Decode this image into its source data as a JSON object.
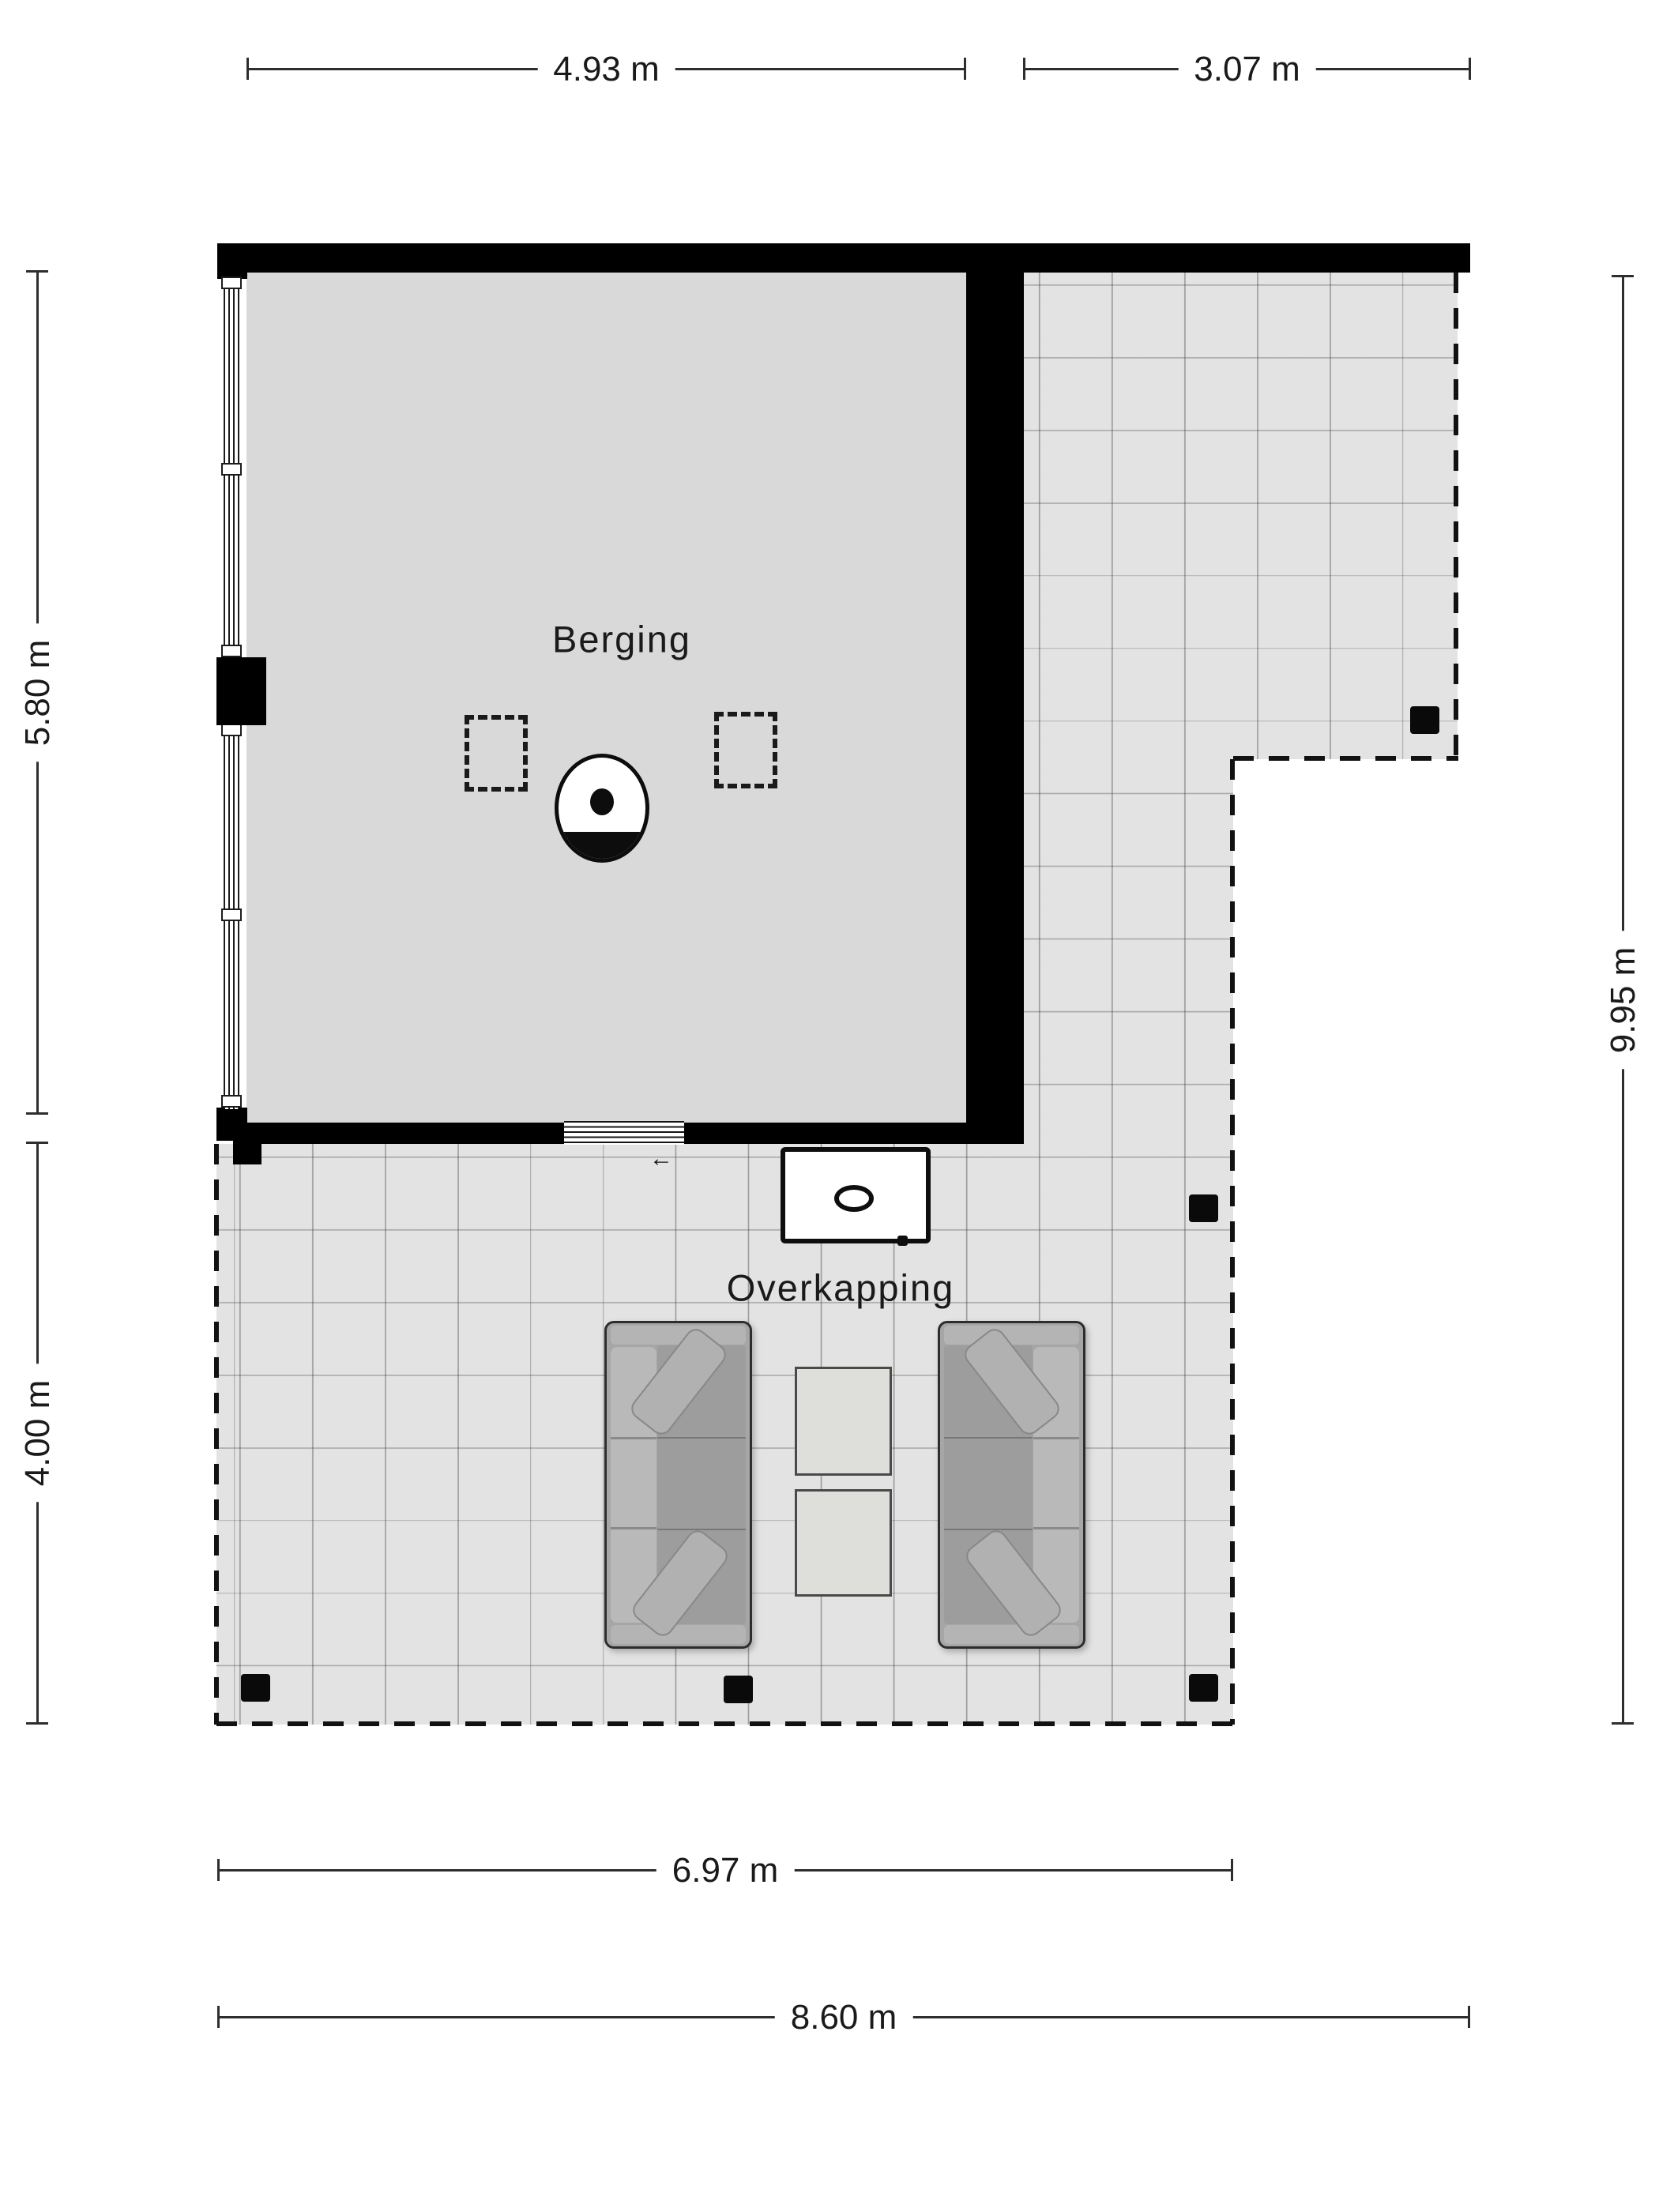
{
  "plan": {
    "type": "floor-plan",
    "rooms": [
      {
        "id": "berging",
        "label": "Berging"
      },
      {
        "id": "overkapping",
        "label": "Overkapping"
      }
    ],
    "dimensions": {
      "top": [
        {
          "label": "4.93 m"
        },
        {
          "label": "3.07 m"
        }
      ],
      "left": [
        {
          "label": "5.80 m"
        },
        {
          "label": "4.00 m"
        }
      ],
      "right": [
        {
          "label": "9.95 m"
        }
      ],
      "bottom": [
        {
          "label": "6.97 m"
        },
        {
          "label": "8.60 m"
        }
      ]
    },
    "symbols": {
      "door_arrow": "←",
      "sofas": 2,
      "coffee_tables": 2,
      "side_table": 1,
      "stove": 1,
      "skylights": 2,
      "posts": 5
    },
    "colors": {
      "wall": "#000000",
      "room_floor": "#d9d9d9",
      "terrace_floor": "#e3e3e3",
      "grid_line": "#9b9b9b",
      "dashed_boundary": "#121212",
      "dimension_line": "#2e2e2e",
      "text": "#1a1a1a"
    }
  }
}
